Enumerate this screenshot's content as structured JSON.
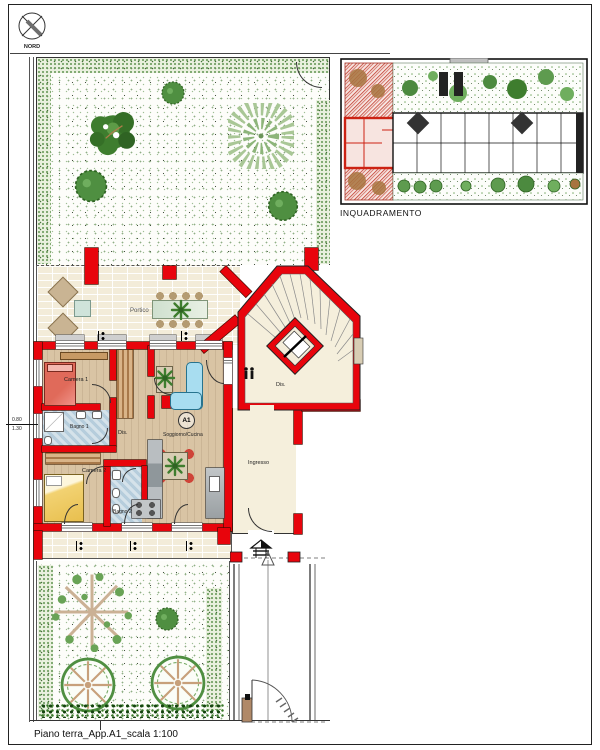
{
  "page": {
    "caption": "Piano terra_App.A1_scala 1:100"
  },
  "compass": {
    "label": "NORD"
  },
  "inset": {
    "caption": "INQUADRAMENTO"
  },
  "rooms": {
    "portico": "Portico",
    "camera1": "Camera 1",
    "bagno1": "Bagno 1",
    "dis1": "Dis.",
    "camera2": "Camera 2",
    "bagno2": "Bagno 2",
    "apartment_id": "A1",
    "soggiorno_cucina": "Soggiorno/Cucina",
    "stair_dis": "Dis.",
    "ingresso": "Ingresso"
  },
  "annotations": {
    "window_width": "0.80",
    "sill_height": "1.30"
  },
  "colors": {
    "wall_red": "#e8040c",
    "brick": "#f3ecd9",
    "wood_floor": "#d9c4a4",
    "bath_tile": "#b6cddc",
    "hedge_green": "#6f9e5f",
    "sofa_blue": "#a8ddf0",
    "bed1_red": "#e06a5a",
    "bed2_yellow": "#f2d272",
    "inset_hatch": "#c0392b"
  }
}
